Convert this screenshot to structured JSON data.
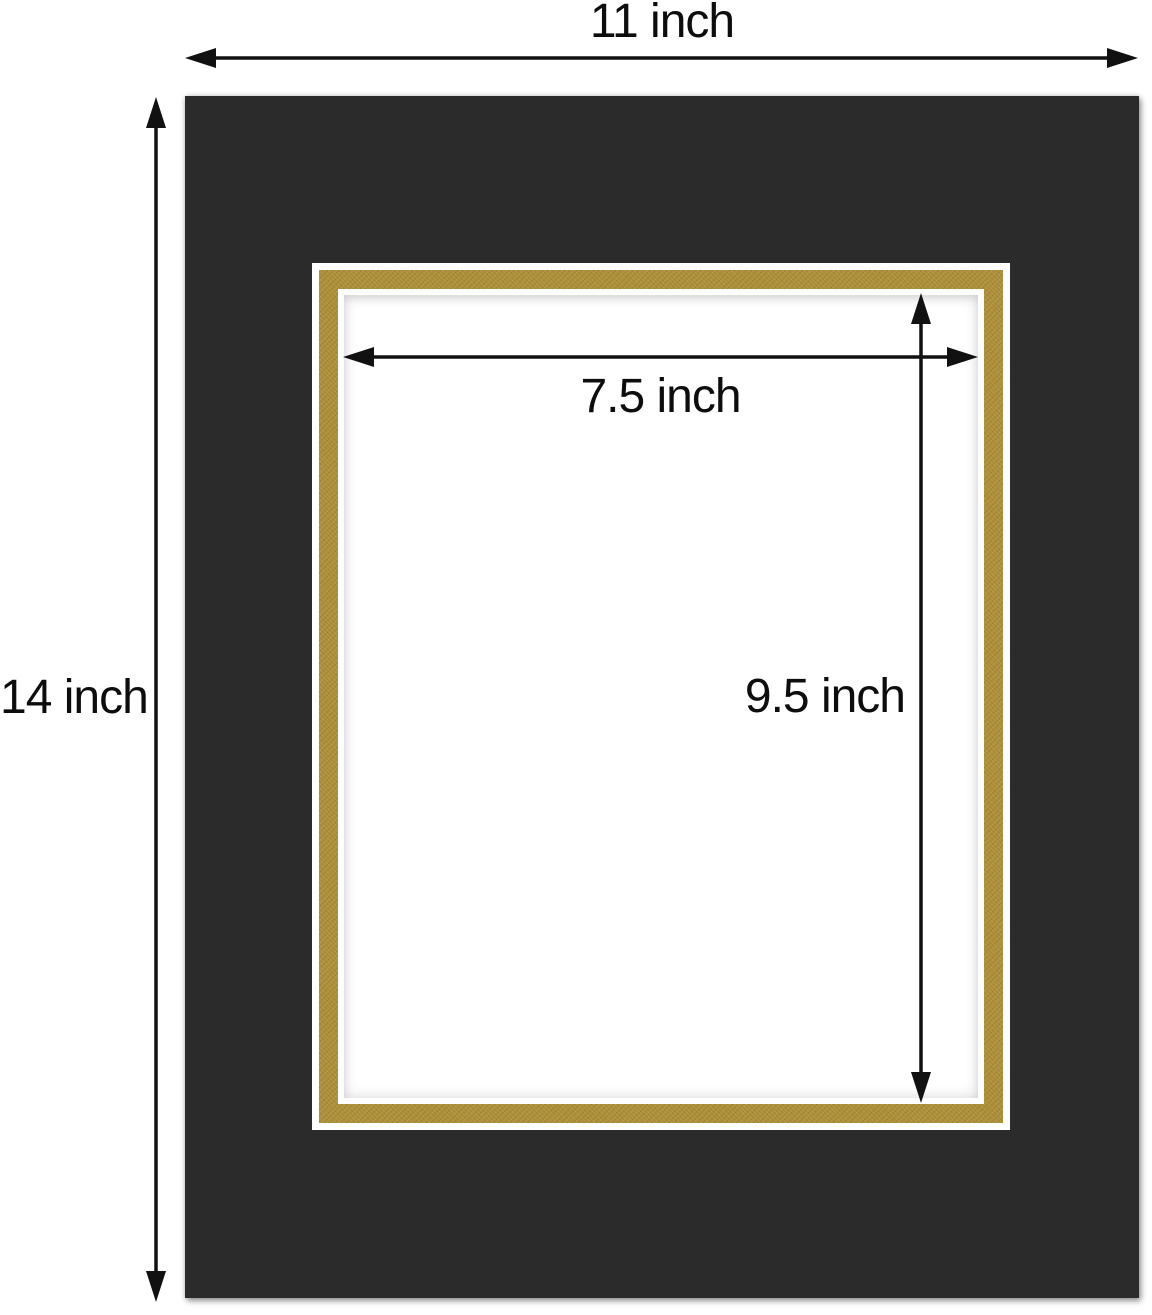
{
  "diagram": {
    "labels": {
      "outer_width": "11 inch",
      "outer_height": "14 inch",
      "opening_width": "7.5 inch",
      "opening_height": "9.5 inch"
    },
    "colors": {
      "mat_black": "#2b2b2b",
      "gold_accent": "#ad8f37",
      "core_white": "#ffffff",
      "arrow": "#111111"
    }
  }
}
